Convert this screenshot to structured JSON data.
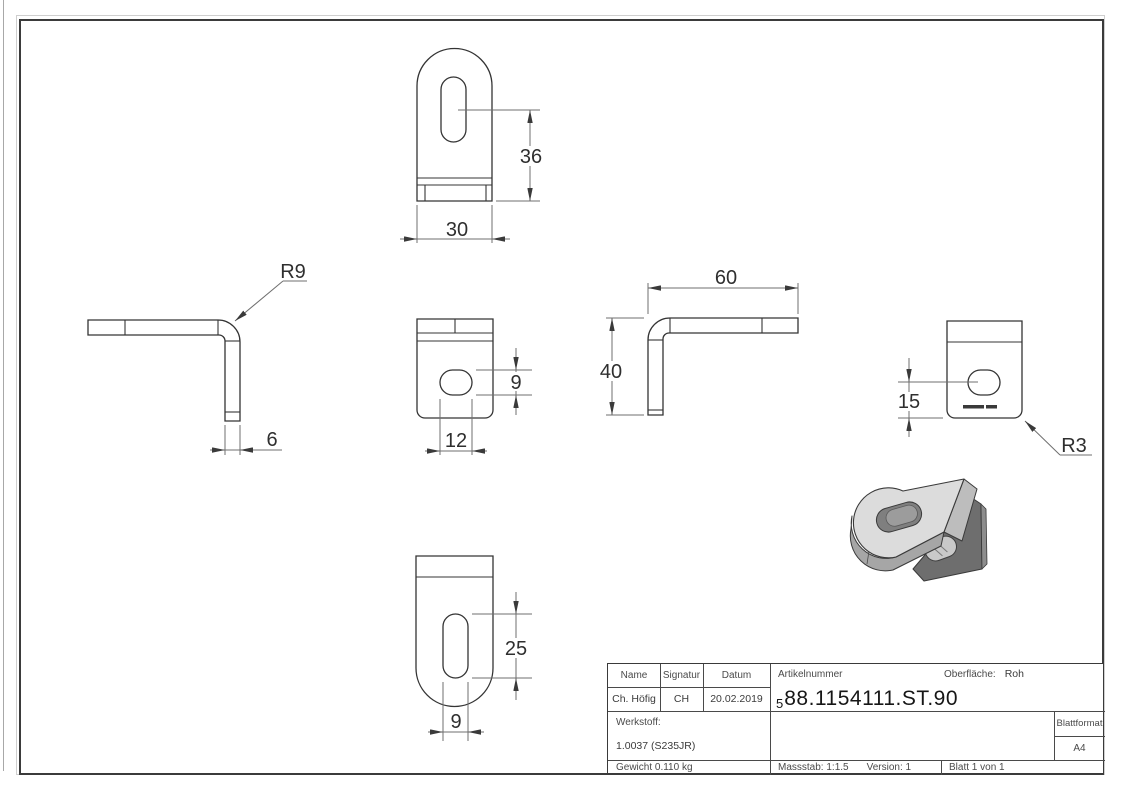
{
  "drawing": {
    "views": {
      "top": {
        "height": "36",
        "width": "30"
      },
      "side": {
        "radius": "R9",
        "thickness": "6"
      },
      "front": {
        "slot_height": "9",
        "slot_width": "12"
      },
      "angle": {
        "width": "60",
        "height": "40"
      },
      "back": {
        "slot_center": "15",
        "corner_radius": "R3"
      },
      "bottom": {
        "slot_length": "25",
        "slot_width": "9"
      }
    }
  },
  "title_block": {
    "labels": {
      "name": "Name",
      "signature": "Signatur",
      "date": "Datum",
      "article_number": "Artikelnummer",
      "surface": "Oberfläche:",
      "material": "Werkstoff:",
      "sheet_format": "Blattformat"
    },
    "values": {
      "name": "Ch. Höfig",
      "signature": "CH",
      "date": "20.02.2019",
      "article_prefix": "5",
      "article_number": "88.1154111.ST.90",
      "surface": "Roh",
      "material": "1.0037 (S235JR)",
      "sheet_format": "A4",
      "weight": "Gewicht 0.110 kg",
      "scale": "Massstab: 1:1.5",
      "version": "Version: 1",
      "sheet": "Blatt 1 von 1"
    }
  },
  "colors": {
    "edge_line": "#343434",
    "dim_line": "#6f6f6f",
    "background": "#ffffff",
    "iso_top_face": "#dcdcdc",
    "iso_side_face": "#6e6e6e",
    "iso_rim": "#a6a6a6"
  }
}
